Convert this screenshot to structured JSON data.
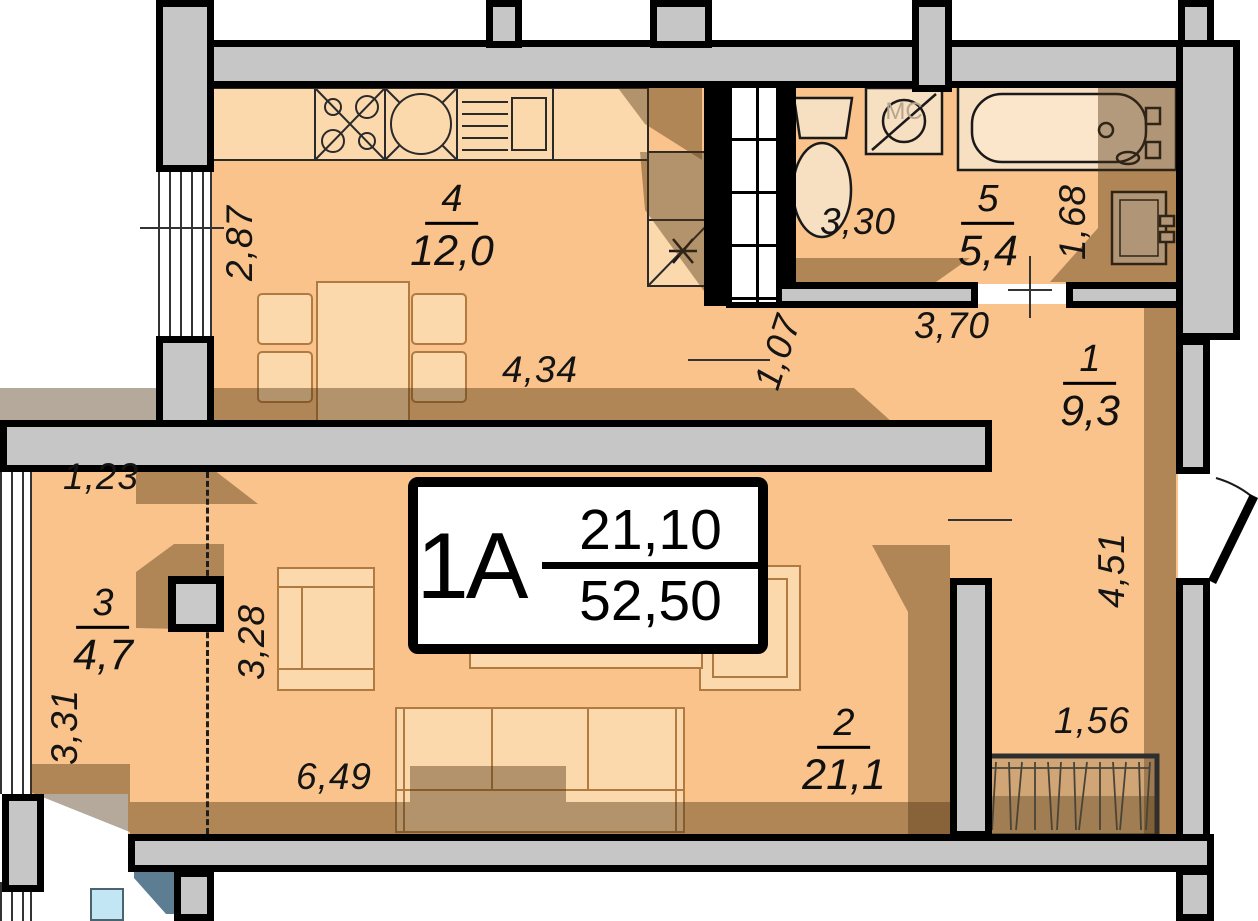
{
  "plan_card": {
    "flat_label": "1А",
    "upper_area": "21,10",
    "lower_area": "52,50"
  },
  "rooms": {
    "hall": {
      "number": "1",
      "area": "9,3"
    },
    "living": {
      "number": "2",
      "area": "21,1"
    },
    "loggia": {
      "number": "3",
      "area": "4,7"
    },
    "kitchen": {
      "number": "4",
      "area": "12,0"
    },
    "bathroom": {
      "number": "5",
      "area": "5,4"
    }
  },
  "dimensions": {
    "kitchen_width": "2,87",
    "kitchen_length": "4,34",
    "kitchen_passage": "1,07",
    "bathroom_length": "3,30",
    "bathroom_width": "1,68",
    "hall_top_width": "3,70",
    "hall_height": "4,51",
    "closet_width": "1,56",
    "living_length": "6,49",
    "living_height": "3,28",
    "loggia_height": "3,31",
    "loggia_top": "1,23"
  },
  "labels": {
    "washing_machine": "МС"
  },
  "colors": {
    "floor": "#F9C38B",
    "furniture": "#FBD9AD",
    "wall": "#C6C6C6",
    "shadow": "#4F3310",
    "accent_blue": "#5C7D92",
    "glass_blue": "#C3E6F4"
  }
}
